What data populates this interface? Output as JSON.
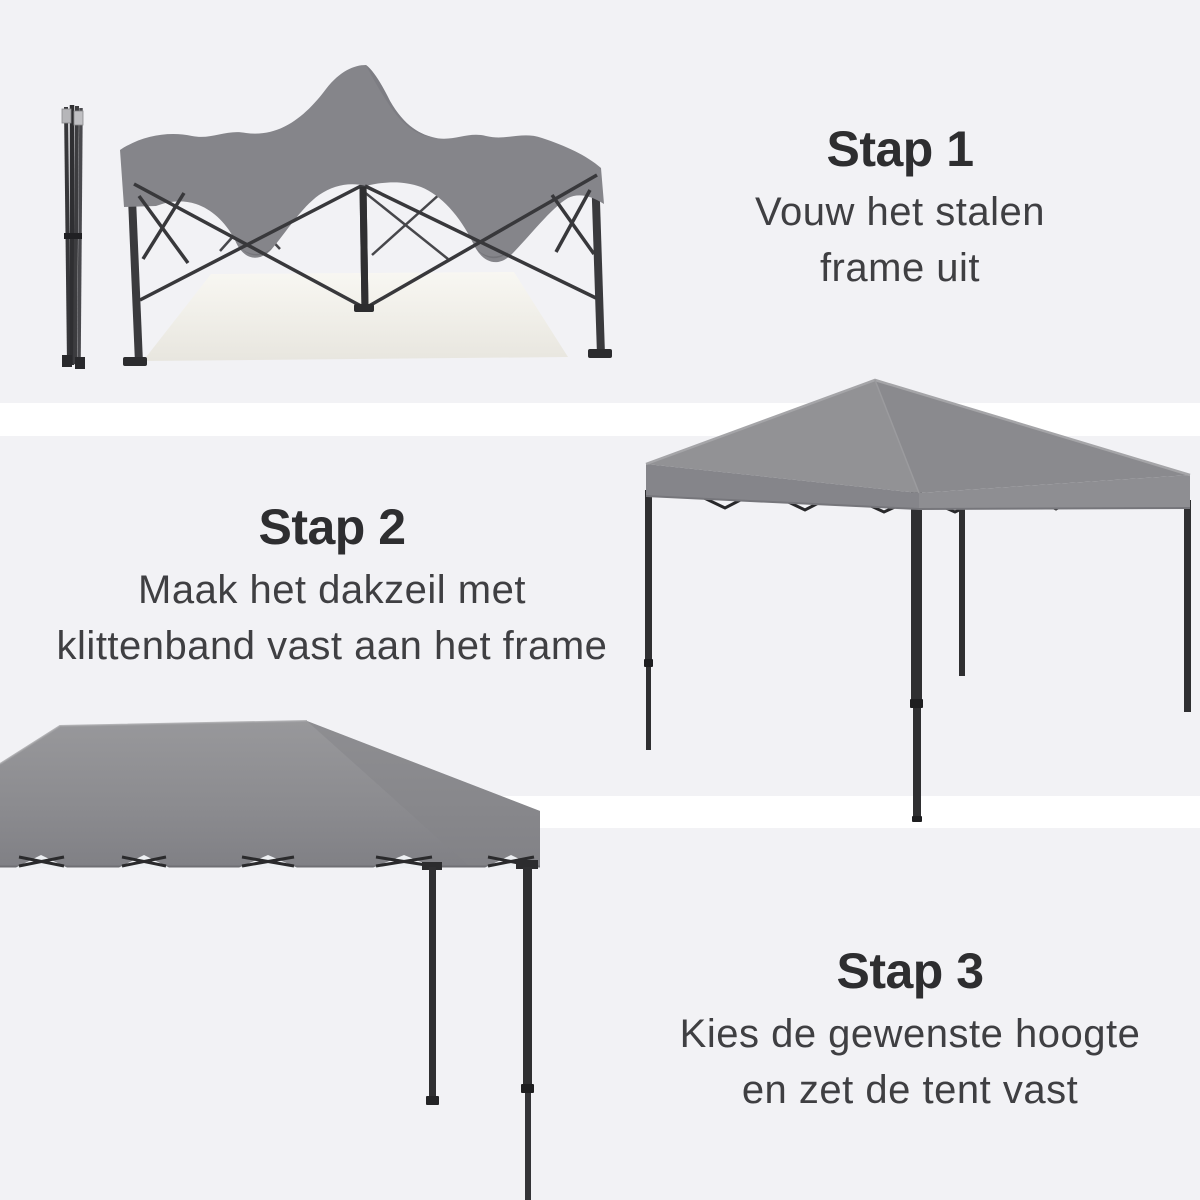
{
  "page": {
    "background": "#f2f2f5",
    "divider_color": "#ffffff"
  },
  "steps": [
    {
      "title": "Stap 1",
      "lines": [
        "Vouw het stalen",
        "frame uit"
      ]
    },
    {
      "title": "Stap 2",
      "lines": [
        "Maak het dakzeil met",
        "klittenband vast aan het frame"
      ]
    },
    {
      "title": "Stap 3",
      "lines": [
        "Kies de gewenste hoogte",
        "en zet de tent vast"
      ]
    }
  ],
  "illustrations": {
    "step1": "folded-steel-frame-and-unfolded-frame-with-draped-canopy",
    "step2": "assembled-pop-up-tent-with-canopy-attached",
    "step3": "canopy-closeup-with-height-adjustable-legs"
  },
  "colors": {
    "canopy_gray": "#8d8d90",
    "canopy_dark_fold": "#75757a",
    "frame_dark": "#2e2e30",
    "floor_cream": "#f5f4ee",
    "heading_text": "#2e2e30",
    "body_text": "#3f3f42"
  }
}
